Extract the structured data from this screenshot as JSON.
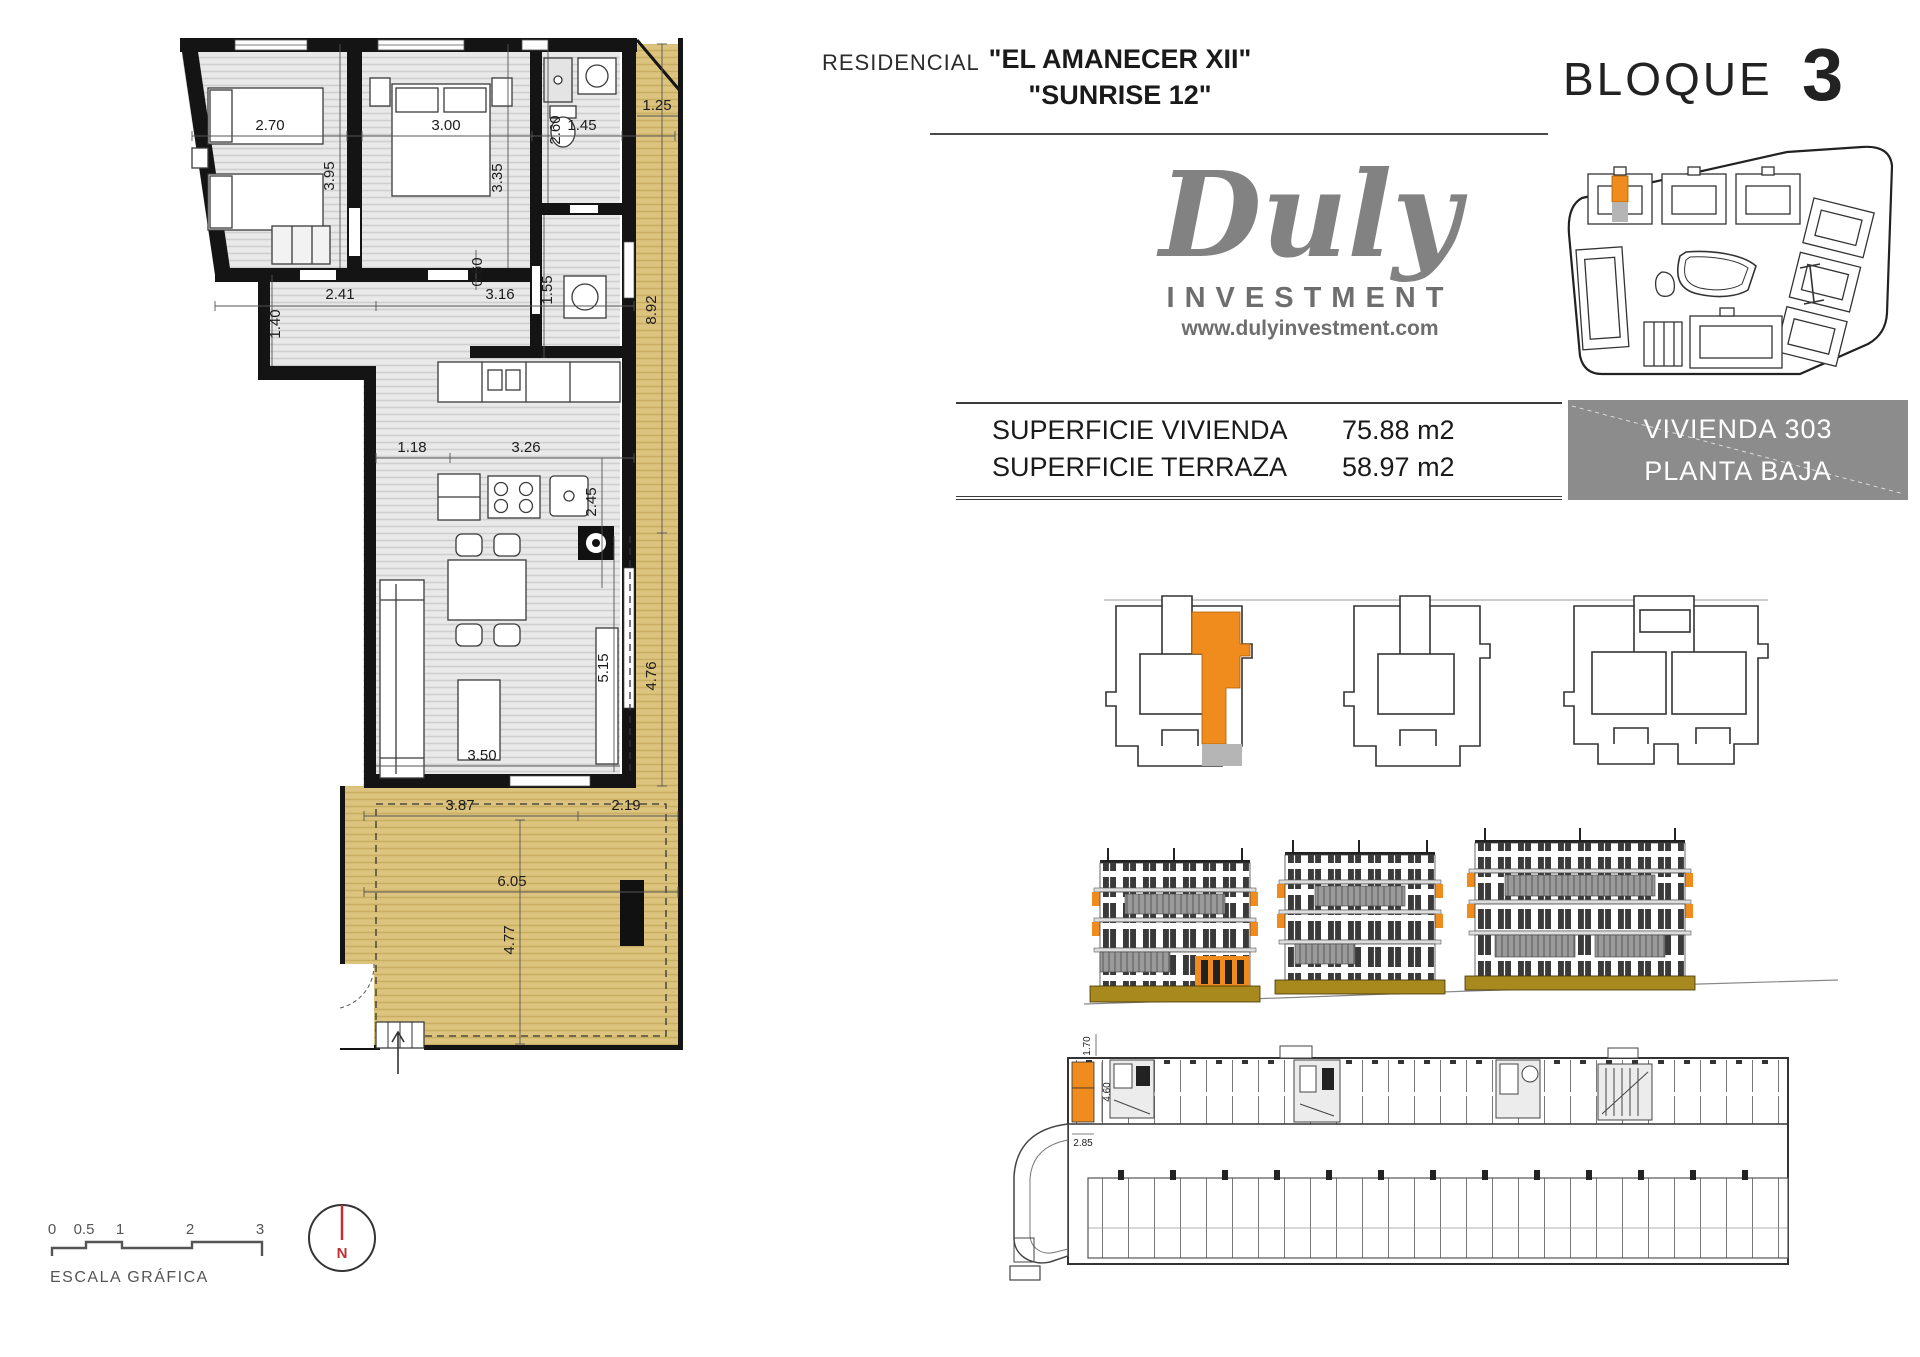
{
  "header": {
    "residencial": "RESIDENCIAL",
    "name_line1": "\"EL AMANECER XII\"",
    "name_line2": "\"SUNRISE 12\"",
    "bloque_label": "BLOQUE",
    "bloque_number": "3"
  },
  "logo": {
    "brand": "Duly",
    "subtitle": "INVESTMENT",
    "website": "www.dulyinvestment.com"
  },
  "surface_table": {
    "rows": [
      {
        "label": "SUPERFICIE VIVIENDA",
        "value": "75.88 m2"
      },
      {
        "label": "SUPERFICIE TERRAZA",
        "value": "58.97 m2"
      }
    ]
  },
  "unit_box": {
    "line1": "VIVIENDA 303",
    "line2": "PLANTA BAJA"
  },
  "floor_plan": {
    "dimensions": [
      "2.70",
      "3.00",
      "1.45",
      "1.25",
      "3.95",
      "3.35",
      "2.60",
      "0.60",
      "2.41",
      "3.16",
      "1.40",
      "1.55",
      "8.92",
      "1.18",
      "3.26",
      "2.45",
      "5.15",
      "4.76",
      "3.50",
      "3.87",
      "2.19",
      "6.05",
      "4.77"
    ]
  },
  "parking_plan": {
    "dimensions": [
      "1.70",
      "4.60",
      "2.85"
    ]
  },
  "scale_bar": {
    "ticks": [
      "0",
      "0.5",
      "1",
      "2",
      "3"
    ],
    "label": "ESCALA GRÁFICA"
  },
  "north_indicator": {
    "label": "N"
  },
  "colors": {
    "accent_orange": "#F08C1E",
    "terrace_tan": "#DCC47F",
    "ground_ochre": "#A8891E",
    "unit_box_gray": "#8C8C8C"
  }
}
